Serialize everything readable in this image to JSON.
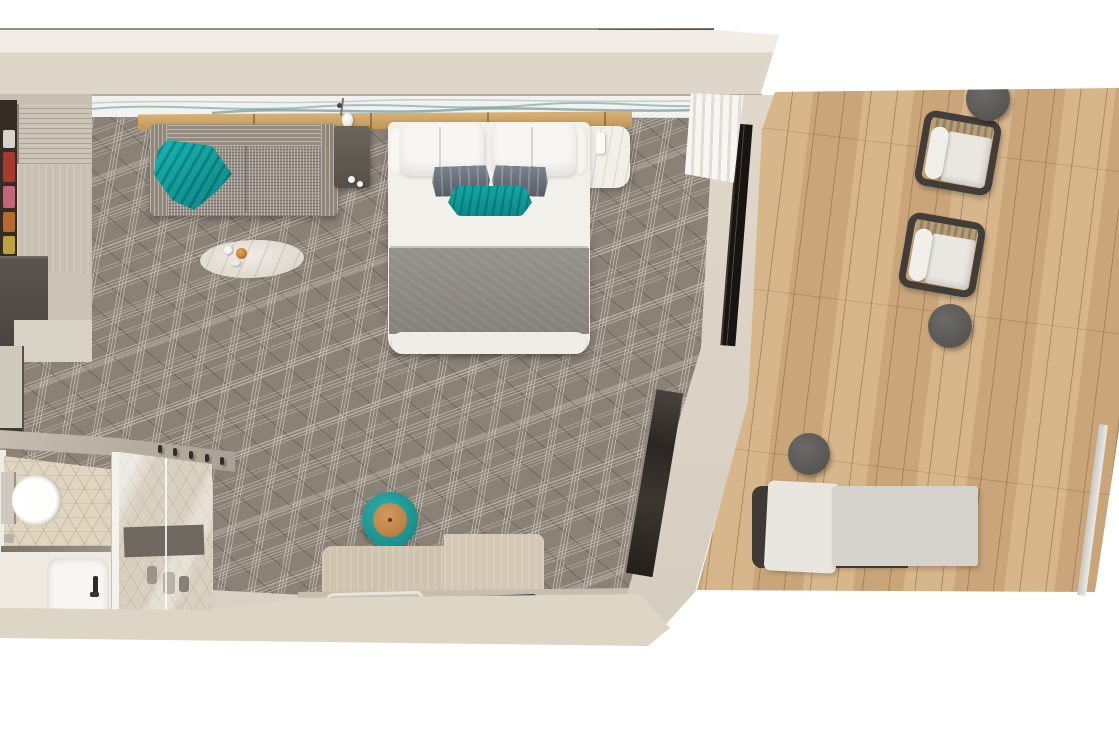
{
  "scene": {
    "label": "Top-down 3D render of a cruise ship balcony stateroom floor plan",
    "background": "#ffffff"
  },
  "palette": {
    "wall_cream": "#ded6c8",
    "wall_light": "#f1ede6",
    "carpet_taupe": "#8a8177",
    "carpet_line": "#dfd8ce",
    "deck_wood": "#d2ad80",
    "headboard_wood": "#cfa76b",
    "teal_accent": "#0fa3a2",
    "bed_white": "#f2f0ea",
    "blanket_gray": "#8e8a84",
    "door_dark": "#26221f",
    "bath_tile": "#e0d5c0",
    "stool_leather": "#c08448",
    "wicker_frame": "#423d38",
    "cushion_white": "#e9e7e0"
  },
  "areas": {
    "cabin": {
      "label": "Main cabin with bed, sofa and desk"
    },
    "balcony": {
      "label": "Private balcony with wood decking"
    },
    "bathroom": {
      "label": "Bathroom with toilet, vanity and glass shower"
    },
    "wardrobe": {
      "label": "Wardrobe and open closet with clothes"
    },
    "entry": {
      "label": "Entry vestibule with coat hooks"
    }
  },
  "furniture": {
    "sofa": {
      "label": "Tweed sofa with teal throw blanket"
    },
    "coffee_table": {
      "label": "Oval marble coffee table with candle and cups"
    },
    "bed": {
      "label": "Double bed with white duvet, gray pillows and teal bolster"
    },
    "bed_bench": {
      "label": "White bench at foot of bed"
    },
    "nightstand_left": {
      "label": "Dark side table with cups"
    },
    "nightstand_right": {
      "label": "White marble nightstand"
    },
    "artwork": {
      "label": "Wave artwork strip above headboard"
    },
    "pendant": {
      "label": "Pendant lamp over headboard shelf"
    },
    "desk": {
      "label": "Desk with wood privacy panels, tray and book"
    },
    "stool": {
      "label": "Round teal stool with leather top"
    },
    "toilet": {
      "label": "Toilet"
    },
    "vanity": {
      "label": "Vanity counter with sink and faucet"
    },
    "shower": {
      "label": "Glass-enclosed shower with bench"
    },
    "hooks": {
      "label": "Row of coat hooks on angled entry wall"
    },
    "balcony_door": {
      "label": "Dark sliding balcony door"
    },
    "curtain": {
      "label": "Folded white curtain"
    },
    "mirror": {
      "label": "Full-length mirror on angled wall"
    },
    "wicker_chair_1": {
      "label": "Wicker armchair with white cushions"
    },
    "wicker_chair_2": {
      "label": "Wicker armchair with white cushions"
    },
    "side_table_top": {
      "label": "Round metal side table"
    },
    "side_table_mid": {
      "label": "Round metal side table"
    },
    "side_table_low": {
      "label": "Round metal side table"
    },
    "lounger": {
      "label": "Cushioned balcony lounger"
    }
  }
}
